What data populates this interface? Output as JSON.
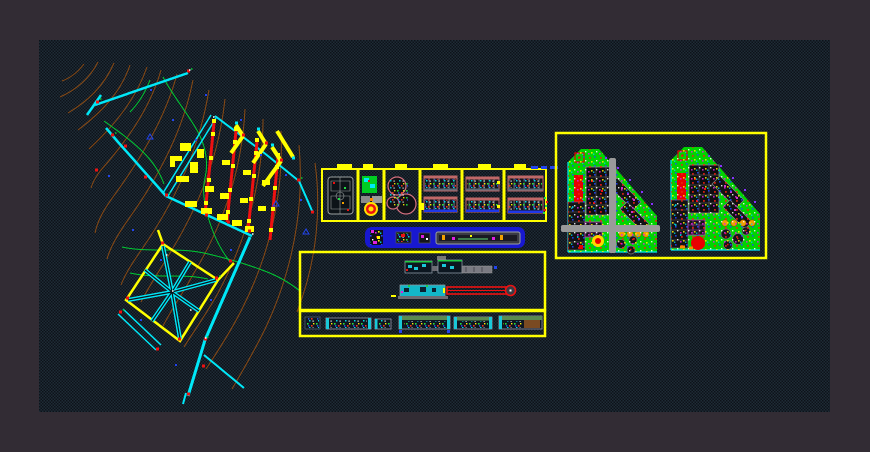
{
  "window": {
    "title": "CAD drawing viewport",
    "outer_background": "#322c34",
    "canvas_background": "#0d1219",
    "canvas_dither_dot": "#1e2c36"
  },
  "palette": {
    "yellow": "#ffff00",
    "cyan": "#00e8f8",
    "red": "#ee1111",
    "green": "#00cc33",
    "brown": "#8a4a14",
    "blue": "#2244ee",
    "rose": "#c06868",
    "gray": "#9aa0a0",
    "orange": "#f0a000",
    "magenta": "#e020e0",
    "barblue": "#1818d0",
    "plangreen": "#00d400"
  },
  "regions": {
    "site_plan": {
      "id": "site-plan",
      "features": [
        "contour-lines",
        "cyan-road-network",
        "red-utility-mains",
        "yellow-buildings",
        "green-service-lines",
        "diamond-park-with-radial-paths"
      ]
    },
    "detail_strip": {
      "id": "detail-panel-strip",
      "panel_count": 6,
      "panels": [
        {
          "id": "sports-court-plan"
        },
        {
          "id": "pool-and-logo-plan"
        },
        {
          "id": "cluster-site-plan"
        },
        {
          "id": "housing-block-plan-a"
        },
        {
          "id": "housing-block-plan-b"
        },
        {
          "id": "housing-block-plan-c"
        }
      ]
    },
    "blue_bar": {
      "id": "elevation-thumbnails-bar",
      "item_count": 4
    },
    "sections_box": {
      "id": "building-sections-box",
      "rows": 2
    },
    "elevations_strip": {
      "id": "small-elevations-strip",
      "item_count": 6
    },
    "right_box": {
      "id": "master-plan-pair-box",
      "plans": [
        {
          "id": "master-plan-with-road-overlay"
        },
        {
          "id": "master-plan-with-red-circle"
        }
      ]
    }
  }
}
